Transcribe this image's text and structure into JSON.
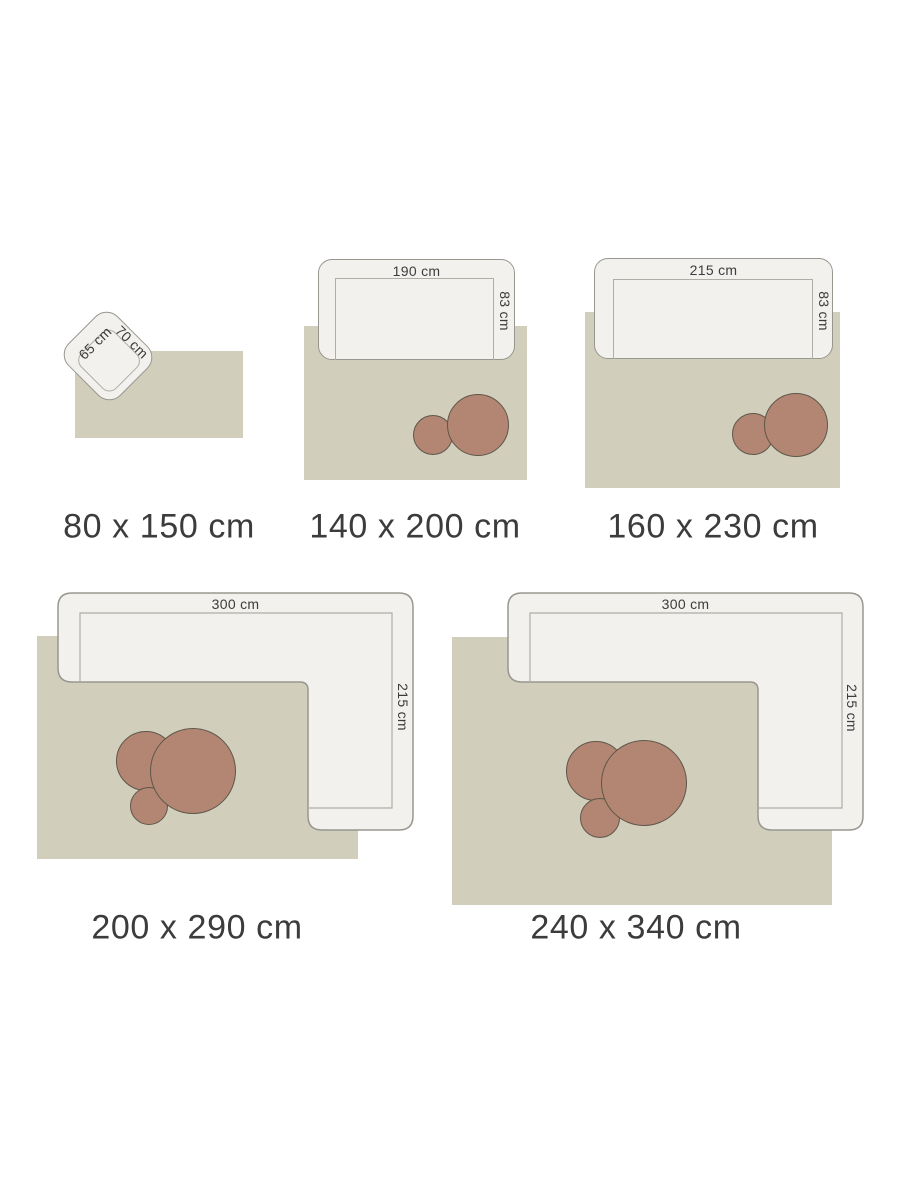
{
  "colors": {
    "background": "#ffffff",
    "rug": "#d1cebc",
    "sofa_fill": "#f2f1ee",
    "sofa_border": "#98978f",
    "seat_line": "#aeada6",
    "table_fill": "#b28672",
    "table_border": "#5e564a",
    "text": "#3c3c3c"
  },
  "panels": [
    {
      "furniture": "armchair",
      "width_label": "65 cm",
      "depth_label": "70 cm",
      "size_label": "80 x 150 cm"
    },
    {
      "furniture": "sofa",
      "width_label": "190 cm",
      "depth_label": "83 cm",
      "size_label": "140 x 200 cm"
    },
    {
      "furniture": "sofa",
      "width_label": "215 cm",
      "depth_label": "83 cm",
      "size_label": "160 x 230 cm"
    },
    {
      "furniture": "corner-sofa",
      "width_label": "300 cm",
      "depth_label": "215 cm",
      "size_label": "200 x 290 cm"
    },
    {
      "furniture": "corner-sofa",
      "width_label": "300 cm",
      "depth_label": "215 cm",
      "size_label": "240 x 340 cm"
    }
  ]
}
